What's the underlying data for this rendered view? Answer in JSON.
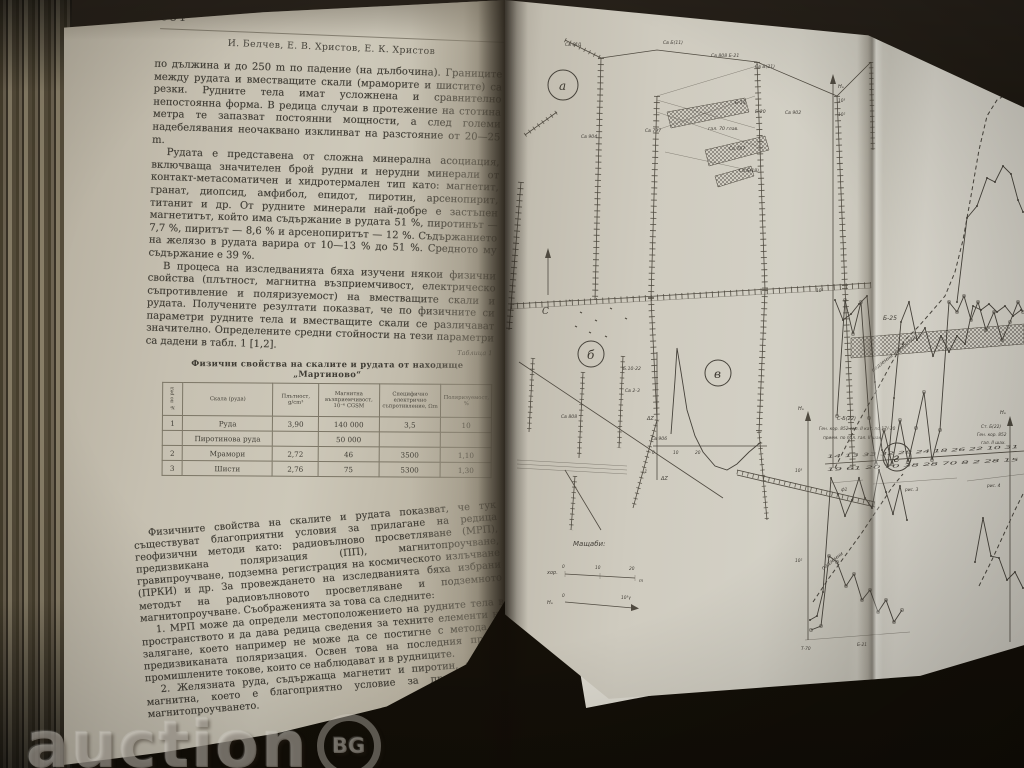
{
  "watermark": {
    "text": "auction",
    "badge": "BG"
  },
  "left_page": {
    "page_number": "384",
    "authors": "И. Белчев, Е. В. Христов, Е. К. Христов",
    "para1": "по дължина и до 250 m по падение (на дълбочина). Границите между рудата и вместващите скали (мраморите и шистите) са резки. Рудните тела имат усложнена и сравнително непостоянна форма. В редица случаи в протежение на стотина метра те запазват постоянни мощности, а след големи надебелявания неочаквано изклинват на разстояние от 20—25 m.",
    "para2": "Рудата е представена от сложна минерална асоциация, включваща значителен брой рудни и нерудни минерали от контакт-метасоматичен и хидротермален тип като: магнетит, гранат, диопсид, амфибол, епидот, пиротин, арсенопирит, титанит и др. От рудните минерали най-добре е застъпен магнетитът, който има съдържание в рудата 51 %, пиротинът — 7,7 %, пиритът — 8,6 % и арсенопиритът — 12 %. Съдържанието на желязо в рудата варира от 10—13 % до 51 %. Средното му съдържание е 39 %.",
    "para3": "В процеса на изследванията бяха изучени някои физични свойства (плътност, магнитна възприемчивост, електрическо съпротивление и поляризуемост) на вместващите скали и рудата. Получените резултати показват, че по физичните си параметри рудните тела и вместващите скали се различават значително. Определените средни стойности на тези параметри са дадени в табл. 1 [1,2].",
    "table": {
      "caption": "Таблица 1",
      "title": "Физични свойства на скалите и рудата от находище „Мартиново“",
      "columns": [
        "№ по ред",
        "Скала (руда)",
        "Плътност, g/cm³",
        "Магнитна възприемчивост, 10⁻⁶ CGSM",
        "Специфично електрично съпротивление, Ωm",
        "Поляризуемост, %"
      ],
      "rows": [
        [
          "1",
          "Руда",
          "3,90",
          "140 000",
          "3,5",
          "10"
        ],
        [
          "",
          "Пиротинова руда",
          "",
          "50 000",
          "",
          ""
        ],
        [
          "2",
          "Мрамори",
          "2,72",
          "46",
          "3500",
          "1,10"
        ],
        [
          "3",
          "Шисти",
          "2,76",
          "75",
          "5300",
          "1,30"
        ]
      ]
    },
    "para4": "Физичните свойства на скалите и рудата показват, че тук съществуват благоприятни условия за прилагане на редица геофизични методи като: радиовълново просветляване (МРП), предизвикана поляризация (ПП), магнитопроучване, гравипроучване, подземна регистрация на космическото излъчване (ПРКИ) и др. За провеждането на изследванията бяха избрани методът на радиовълновото просветляване и подземното магнитопроучване. Съображенията за това са следните:",
    "para5": "1. МРП може да определи местоположението на рудните тела в пространството и да дава редица сведения за техните елементи на залягане, което например не може да се постигне с метода на предизвиканата поляризация. Освен това на последния пречат промишлените токове, които се наблюдават и в рудниците.",
    "para6": "2. Желязната руда, съдържаща магнетит и пиротин, е силно магнитна, което е благоприятно условие за прилагане на магнитопроучването."
  },
  "right_page": {
    "fig_a": "а",
    "fig_b": "б",
    "fig_v": "в",
    "fig_g": "г",
    "north": "С",
    "map_labels": [
      "Св 610",
      "Св Б(11)",
      "Св 808 Б-21",
      "Св В(21)",
      "Б-19",
      "Б-20",
      "Св 797",
      "гал. 70 глав.",
      "Св 902",
      "Св 787",
      "Св Б(18)",
      "Св 904",
      "Св 906"
    ],
    "sketch_labels": [
      "Св 808",
      "Б.10-22",
      "Св 2-3"
    ],
    "curve": {
      "dz": "ΔZ",
      "zero": "0",
      "x10": "10",
      "x20": "20",
      "neg": "-1",
      "dz2": "ΔZ"
    },
    "scales": {
      "title": "Мащаби:",
      "hor": "хор.",
      "m0": "0",
      "m10": "10",
      "m20": "20",
      "munit": "m",
      "field": "Нₐ",
      "f0": "0",
      "fmax": "10³γ"
    },
    "profile": {
      "axis": "Нₐ",
      "t1": "10³",
      "t2": "10²",
      "t3": "10²",
      "band": "Б-25",
      "dashlbl": "подземни изработки",
      "xrow1": "14 13 33 32 28 24 18 26 22 10 31",
      "xrow2": "19 61 20 70 38 28 70 8 2 28 15",
      "b1": "ф1",
      "b2": "рис. 3",
      "b3": "рис. 4",
      "s1": "330,300 338,320 346,314 354,304 362,296 370,382 377,450 383,466 389,398 396,322 404,302 412,340 420,328 428,356 436,336 444,352 452,336 460,344 468,306 476,310 484,304 492,312 500,306 508,316 516,310",
      "s2": "332,416 340,300 348,334 356,302 364,418 371,464 379,430 387,464 395,420 403,462 411,428 419,392 427,460 435,430 444,302 452,312 459,296 466,320 473,302 481,330 489,312 497,340 505,322 513,302 518,312",
      "s4": "452,302 462,218 472,206 482,178 490,182 498,166 506,174 513,200 518,212",
      "dash": "330,468 344,440 358,414 372,390 386,364 400,340 414,326 428,310 440,296 450,272 458,240 466,196 474,150 482,116 492,100 502,94 512,92 518,94"
    },
    "gchart": {
      "axis": "Нₐ",
      "t1": "10³",
      "t2": "10²",
      "note1": "С-Б(22)",
      "note2": "Ген. кор. 852 гал. II кат. по 17/-30",
      "note3": "прием. по пол. гал. II шах.",
      "dashlbl": "подземни",
      "lblL": "Т-70",
      "lblR": "Б-21",
      "g1": "305,620 312,616 318,592 326,478 333,494 340,516 347,500 354,478 360,498 367,508 374,470 381,492 388,514 395,486 402,520",
      "g2": "306,630 316,626 324,556 332,562 341,586 349,574 357,600 365,590 373,612 381,600 389,622 397,610",
      "gd": "308,602 324,578 340,556 356,534 372,510 388,486 398,474"
    },
    "rchart": {
      "axis": "Нₐ",
      "note1": "Ст. Б(22)",
      "note2": "Ген. кор. 852",
      "note3": "гал. II шах.",
      "r1": "470,562 478,518 486,556 494,558 502,580 510,572 518,588",
      "rd": "474,586 486,562 498,536 510,510 518,494"
    }
  }
}
